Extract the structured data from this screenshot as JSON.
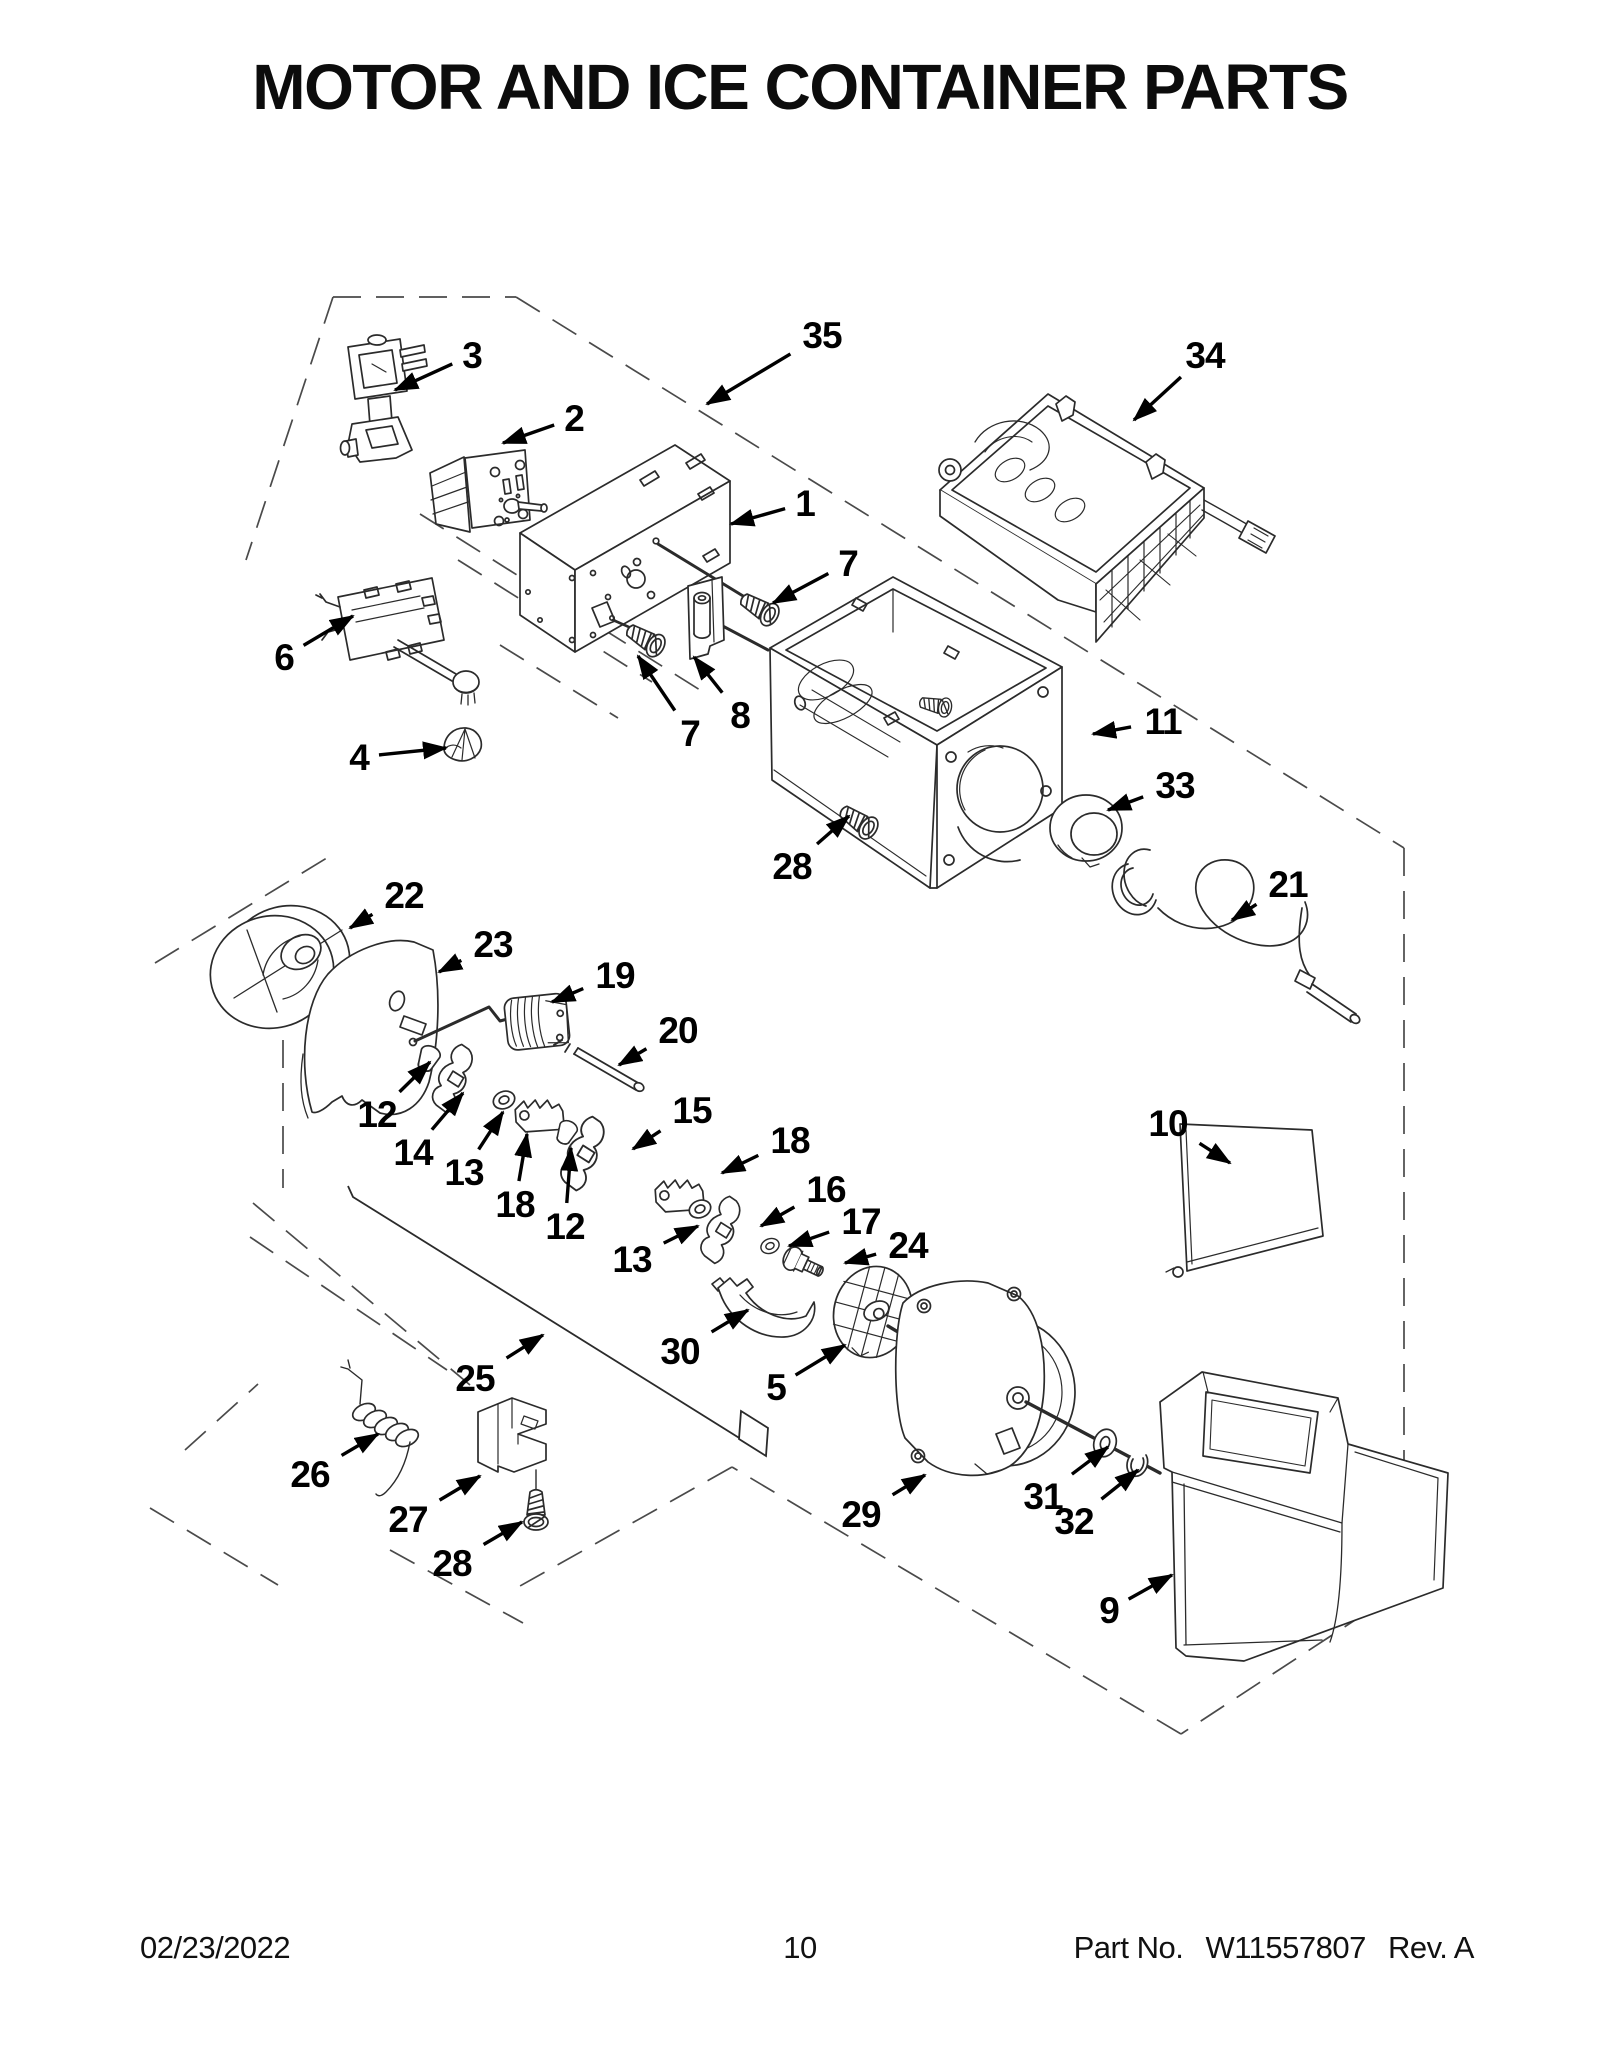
{
  "page": {
    "title": "MOTOR AND ICE CONTAINER PARTS"
  },
  "footer": {
    "date": "02/23/2022",
    "page_number": "10",
    "part_label": "Part No.",
    "part_number": "W11557807",
    "revision": "Rev.  A"
  },
  "diagram": {
    "description": "Exploded parts diagram of refrigerator ice container and auger motor assembly",
    "callouts": [
      {
        "label": "1",
        "lx": 805,
        "ly": 503,
        "tx": 731,
        "ty": 524
      },
      {
        "label": "2",
        "lx": 574,
        "ly": 418,
        "tx": 503,
        "ty": 443
      },
      {
        "label": "3",
        "lx": 472,
        "ly": 355,
        "tx": 395,
        "ty": 390
      },
      {
        "label": "4",
        "lx": 359,
        "ly": 757,
        "tx": 446,
        "ty": 748
      },
      {
        "label": "5",
        "lx": 776,
        "ly": 1387,
        "tx": 845,
        "ty": 1345
      },
      {
        "label": "6",
        "lx": 284,
        "ly": 657,
        "tx": 353,
        "ty": 616
      },
      {
        "label": "7",
        "lx": 848,
        "ly": 563,
        "tx": 773,
        "ty": 603
      },
      {
        "label": "7",
        "lx": 690,
        "ly": 733,
        "tx": 638,
        "ty": 656
      },
      {
        "label": "8",
        "lx": 740,
        "ly": 715,
        "tx": 694,
        "ty": 657
      },
      {
        "label": "9",
        "lx": 1109,
        "ly": 1610,
        "tx": 1172,
        "ty": 1575
      },
      {
        "label": "10",
        "lx": 1168,
        "ly": 1123,
        "tx": 1230,
        "ty": 1163
      },
      {
        "label": "11",
        "lx": 1163,
        "ly": 721,
        "tx": 1093,
        "ty": 734
      },
      {
        "label": "12",
        "lx": 377,
        "ly": 1114,
        "tx": 430,
        "ty": 1062
      },
      {
        "label": "12",
        "lx": 565,
        "ly": 1226,
        "tx": 571,
        "ty": 1148
      },
      {
        "label": "13",
        "lx": 464,
        "ly": 1172,
        "tx": 503,
        "ty": 1112
      },
      {
        "label": "13",
        "lx": 632,
        "ly": 1259,
        "tx": 698,
        "ty": 1226
      },
      {
        "label": "14",
        "lx": 413,
        "ly": 1152,
        "tx": 463,
        "ty": 1093
      },
      {
        "label": "15",
        "lx": 692,
        "ly": 1110,
        "tx": 633,
        "ty": 1149
      },
      {
        "label": "16",
        "lx": 826,
        "ly": 1189,
        "tx": 761,
        "ty": 1226
      },
      {
        "label": "17",
        "lx": 861,
        "ly": 1221,
        "tx": 789,
        "ty": 1246
      },
      {
        "label": "18",
        "lx": 790,
        "ly": 1140,
        "tx": 722,
        "ty": 1173
      },
      {
        "label": "18",
        "lx": 515,
        "ly": 1204,
        "tx": 527,
        "ty": 1134
      },
      {
        "label": "19",
        "lx": 615,
        "ly": 975,
        "tx": 552,
        "ty": 1002
      },
      {
        "label": "20",
        "lx": 678,
        "ly": 1030,
        "tx": 619,
        "ty": 1065
      },
      {
        "label": "21",
        "lx": 1288,
        "ly": 884,
        "tx": 1232,
        "ty": 920
      },
      {
        "label": "22",
        "lx": 404,
        "ly": 895,
        "tx": 350,
        "ty": 928
      },
      {
        "label": "23",
        "lx": 493,
        "ly": 944,
        "tx": 439,
        "ty": 972
      },
      {
        "label": "24",
        "lx": 908,
        "ly": 1245,
        "tx": 845,
        "ty": 1263
      },
      {
        "label": "25",
        "lx": 475,
        "ly": 1378,
        "tx": 543,
        "ty": 1335
      },
      {
        "label": "26",
        "lx": 310,
        "ly": 1474,
        "tx": 378,
        "ty": 1434
      },
      {
        "label": "27",
        "lx": 408,
        "ly": 1519,
        "tx": 480,
        "ty": 1476
      },
      {
        "label": "28",
        "lx": 792,
        "ly": 866,
        "tx": 849,
        "ty": 816
      },
      {
        "label": "28",
        "lx": 452,
        "ly": 1563,
        "tx": 522,
        "ty": 1522
      },
      {
        "label": "29",
        "lx": 861,
        "ly": 1514,
        "tx": 925,
        "ty": 1475
      },
      {
        "label": "30",
        "lx": 680,
        "ly": 1351,
        "tx": 748,
        "ty": 1310
      },
      {
        "label": "31",
        "lx": 1043,
        "ly": 1496,
        "tx": 1108,
        "ty": 1447
      },
      {
        "label": "32",
        "lx": 1074,
        "ly": 1521,
        "tx": 1138,
        "ty": 1470
      },
      {
        "label": "33",
        "lx": 1175,
        "ly": 785,
        "tx": 1108,
        "ty": 810
      },
      {
        "label": "34",
        "lx": 1205,
        "ly": 355,
        "tx": 1134,
        "ty": 420
      },
      {
        "label": "35",
        "lx": 822,
        "ly": 335,
        "tx": 707,
        "ty": 404
      }
    ]
  }
}
